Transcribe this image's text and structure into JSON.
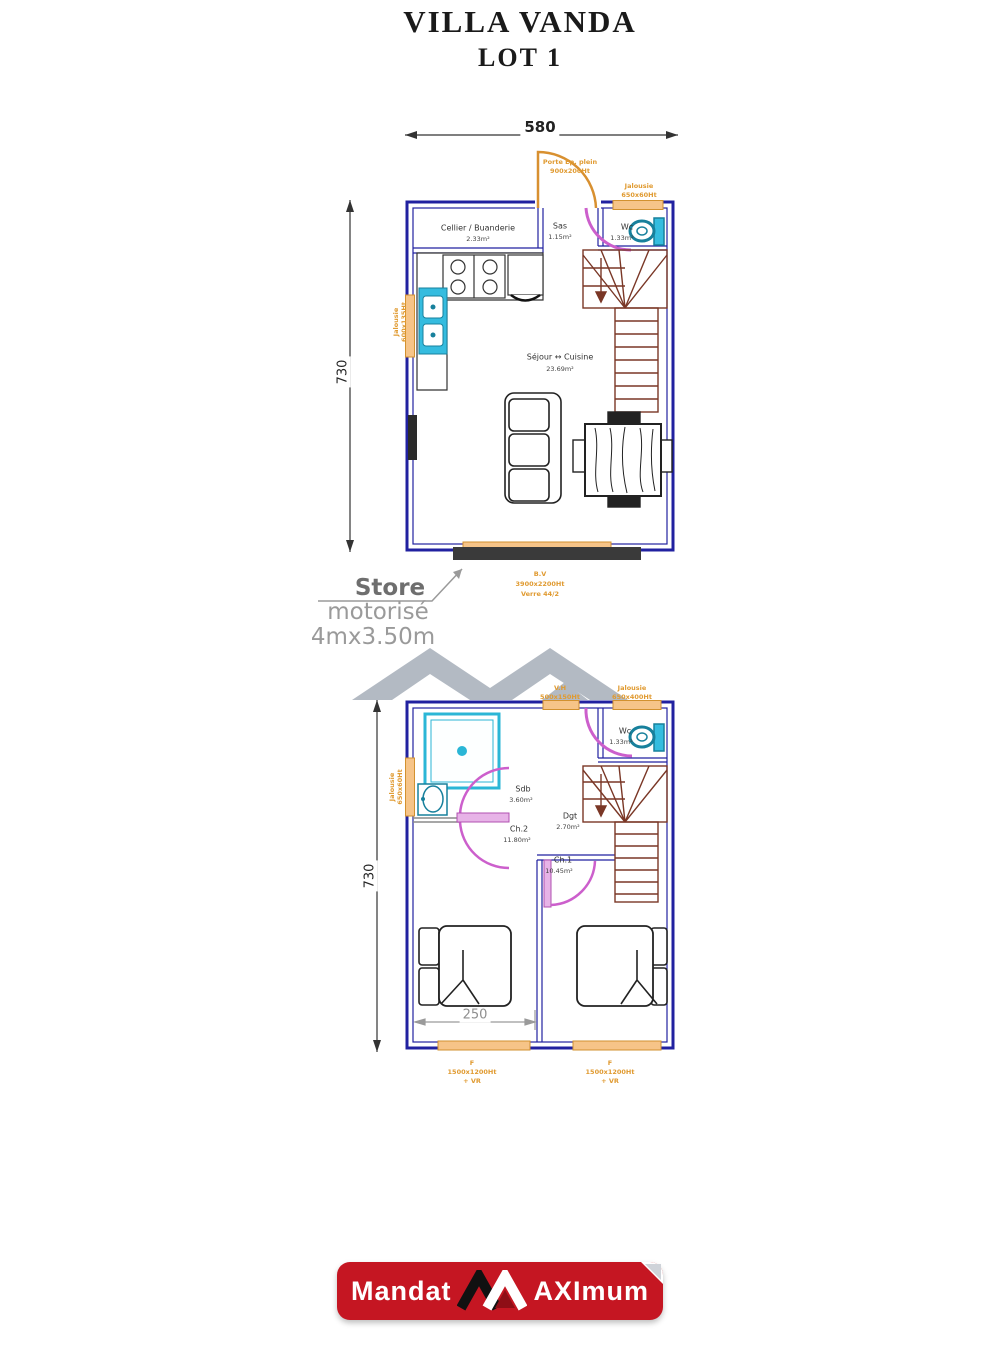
{
  "title": {
    "line1": "VILLA VANDA",
    "line2": "LOT 1"
  },
  "plan_ground": {
    "dim_width": "580",
    "dim_height": "730",
    "door_label_l1": "Porte Ep. plein",
    "door_label_l2": "900x200Ht",
    "window_top_l1": "Jalousie",
    "window_top_l2": "650x60Ht",
    "window_left_l1": "Jalousie",
    "window_left_l2": "600x135Ht",
    "rooms": {
      "cellier": {
        "name": "Cellier / Buanderie",
        "area": "2.33m²"
      },
      "sas": {
        "name": "Sas",
        "area": "1.15m²"
      },
      "wc": {
        "name": "Wc",
        "area": "1.33m²"
      },
      "sejour": {
        "name": "Séjour ↔ Cuisine",
        "area": "23.69m²"
      }
    },
    "bay_l1": "B.V",
    "bay_l2": "3900x2200Ht",
    "bay_l3": "Verre 44/2"
  },
  "store_note": {
    "l1": "Store",
    "l2": "motorisé",
    "l3": "4mx3.50m"
  },
  "plan_first": {
    "dim_height": "730",
    "dim_room": "250",
    "window_top_left_l1": "V.H",
    "window_top_left_l2": "500x150Ht",
    "window_top_right_l1": "Jalousie",
    "window_top_right_l2": "650x400Ht",
    "window_left_l1": "Jalousie",
    "window_left_l2": "650x60Ht",
    "rooms": {
      "wc": {
        "name": "Wc",
        "area": "1.33m²"
      },
      "sdb": {
        "name": "Sdb",
        "area": "3.60m²"
      },
      "ch2": {
        "name": "Ch.2",
        "area": "11.80m²"
      },
      "dgt": {
        "name": "Dgt",
        "area": "2.70m²"
      },
      "ch1": {
        "name": "Ch.1",
        "area": "10.45m²"
      }
    },
    "window_bottom_left": {
      "l1": "F",
      "l2": "1500x1200Ht",
      "l3": "+ VR"
    },
    "window_bottom_right": {
      "l1": "F",
      "l2": "1500x1200Ht",
      "l3": "+ VR"
    }
  },
  "footer": {
    "mandat": "Mandat",
    "aximum": "AXImum"
  }
}
